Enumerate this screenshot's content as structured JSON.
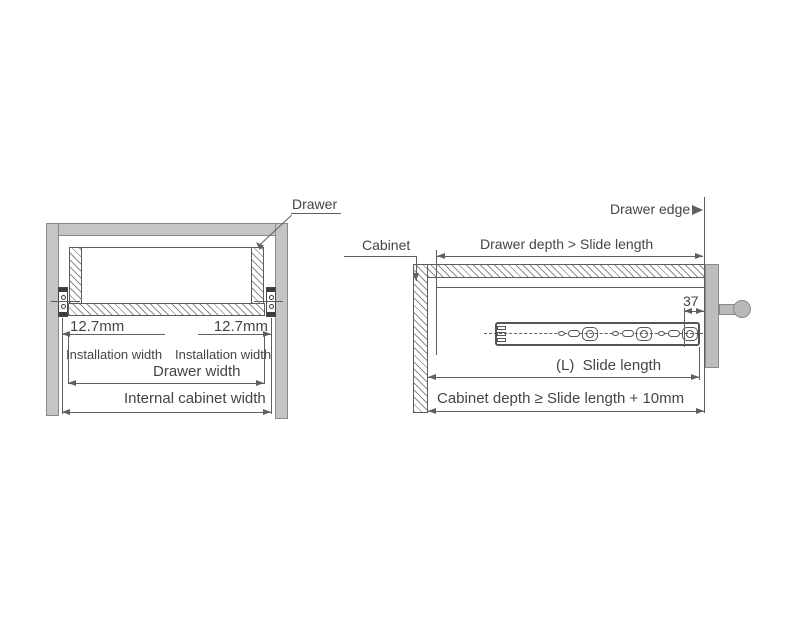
{
  "diagram": {
    "front_view": {
      "drawer_callout": "Drawer",
      "gap_left": "12.7mm",
      "gap_right": "12.7mm",
      "installation_width_left": "Installation width",
      "installation_width_right": "Installation width",
      "drawer_width": "Drawer width",
      "internal_cabinet_width": "Internal cabinet width"
    },
    "side_view": {
      "drawer_edge_callout": "Drawer edge",
      "cabinet_callout": "Cabinet",
      "drawer_depth_dim": "Drawer depth > Slide length",
      "front_offset_dim": "37",
      "slide_length_dim": "(L)  Slide length",
      "cabinet_depth_dim": "Cabinet depth ≥ Slide length + 10mm"
    },
    "colors": {
      "line": "#5f5f5f",
      "text": "#454545",
      "panel_fill": "#c5c5c5",
      "background": "#ffffff"
    }
  }
}
